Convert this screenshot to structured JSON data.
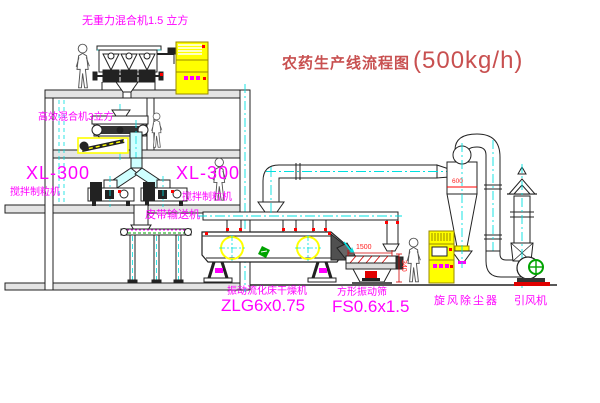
{
  "title": {
    "name": "农药生产线流程图",
    "capacity": "(500kg/h)"
  },
  "labels": {
    "top_mixer": "无重力混合机1.5 立方",
    "mid_mixer": "高效混合机3立方",
    "granulator_left_model": "XL-300",
    "granulator_left_name": "搅拌制粒机",
    "granulator_right_model": "XL-300",
    "granulator_right_name": "搅拌制粒机",
    "belt_conveyor": "皮带输送机",
    "dryer_name": "振动流化床干燥机",
    "dryer_model": "ZLG6x0.75",
    "sieve_name": "方形振动筛",
    "sieve_model": "FS0.6x1.5",
    "cyclone": "旋风除尘器",
    "fan": "引风机"
  },
  "dimensions": {
    "sieve_length": "1500",
    "sieve_height": "340",
    "cyclone_note": "600"
  },
  "colors": {
    "label": "#FF00FF",
    "title": "#C85050",
    "centerline": "#00E0E0",
    "cabinet": "#FFFF00",
    "accent_red": "#FF0000",
    "accent_green": "#00A300",
    "line": "#1C1C1C",
    "background": "#FFFFFF"
  }
}
